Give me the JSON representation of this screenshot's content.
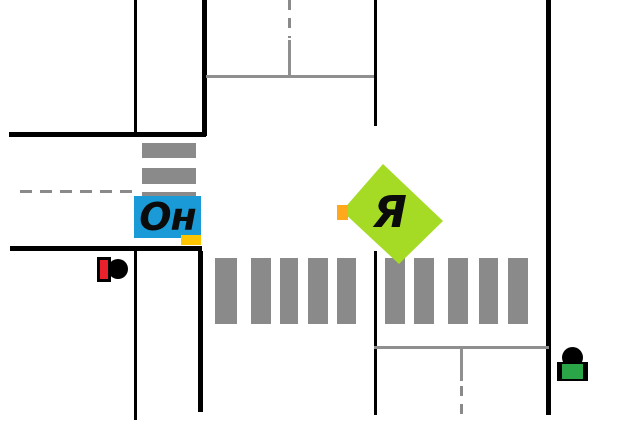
{
  "vehicles": {
    "other_car": {
      "label": "Он",
      "body_color": "#1a9ad6",
      "indicator_color": "#fdc500"
    },
    "my_car": {
      "label": "Я",
      "body_color": "#a5da25",
      "indicator_color": "#ffa81c"
    }
  },
  "signals": {
    "traffic_light": {
      "state": "red",
      "lamp_color": "#e8212c"
    },
    "pedestrian_figure": {
      "state": "green",
      "body_color": "#2aa648"
    }
  },
  "markings": {
    "road_edge_color": "#000000",
    "lane_line_color": "#8f8f8f",
    "crosswalk_stripe_color": "#8a8a8a",
    "horizontal_crosswalk_stripes": 10,
    "vertical_crosswalk_stripes": 3
  }
}
